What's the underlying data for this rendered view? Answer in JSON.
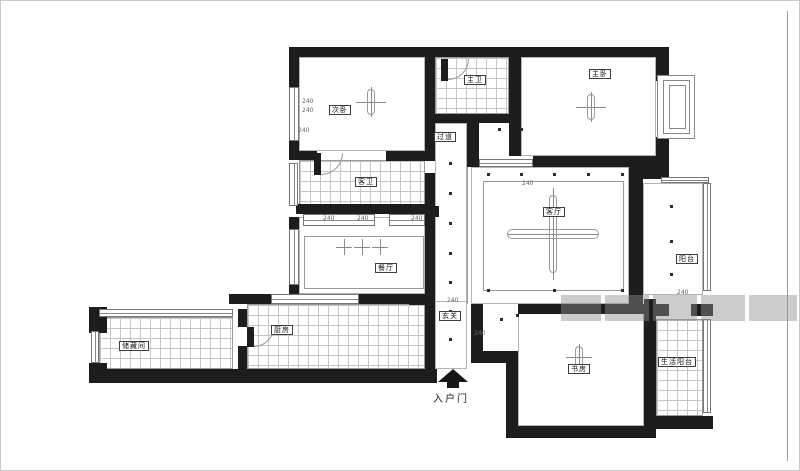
{
  "document": {
    "type": "apartment-floor-plan",
    "background": "#ffffff",
    "wall_color": "#1d1d1d",
    "line_color": "#9a9a9a",
    "watermark_color": "#8f8f8f"
  },
  "plan": {
    "rooms": [
      {
        "id": "ciwo",
        "label": "次卧",
        "x": 298,
        "y": 56,
        "w": 126,
        "h": 94,
        "tiled": false,
        "lx": 328,
        "ly": 104
      },
      {
        "id": "zhuwei",
        "label": "主卫",
        "x": 434,
        "y": 56,
        "w": 74,
        "h": 57,
        "tiled": true,
        "lx": 463,
        "ly": 74
      },
      {
        "id": "zhuwo",
        "label": "主卧",
        "x": 520,
        "y": 56,
        "w": 135,
        "h": 99,
        "tiled": false,
        "lx": 588,
        "ly": 68
      },
      {
        "id": "kewei",
        "label": "客卫",
        "x": 298,
        "y": 159,
        "w": 126,
        "h": 46,
        "tiled": true,
        "lx": 354,
        "ly": 176
      },
      {
        "id": "guodao",
        "label": "过道",
        "x": 434,
        "y": 122,
        "w": 32,
        "h": 246,
        "tiled": false,
        "lx": 433,
        "ly": 131
      },
      {
        "id": "canting",
        "label": "餐厅",
        "x": 298,
        "y": 216,
        "w": 126,
        "h": 77,
        "tiled": false,
        "lx": 374,
        "ly": 262
      },
      {
        "id": "keting",
        "label": "客厅",
        "x": 470,
        "y": 166,
        "w": 158,
        "h": 137,
        "tiled": false,
        "lx": 542,
        "ly": 206
      },
      {
        "id": "yangtai",
        "label": "阳台",
        "x": 642,
        "y": 182,
        "w": 60,
        "h": 112,
        "tiled": false,
        "lx": 675,
        "ly": 253
      },
      {
        "id": "chufang",
        "label": "厨房",
        "x": 246,
        "y": 303,
        "w": 178,
        "h": 65,
        "tiled": true,
        "lx": 270,
        "ly": 324
      },
      {
        "id": "chucangjian",
        "label": "储藏间",
        "x": 98,
        "y": 316,
        "w": 134,
        "h": 52,
        "tiled": true,
        "lx": 118,
        "ly": 340
      },
      {
        "id": "xuanguan",
        "label": "玄关",
        "x": 434,
        "y": 300,
        "w": 32,
        "h": 68,
        "tiled": false,
        "lx": 438,
        "ly": 310
      },
      {
        "id": "shufang",
        "label": "书房",
        "x": 517,
        "y": 305,
        "w": 126,
        "h": 120,
        "tiled": false,
        "lx": 567,
        "ly": 363
      },
      {
        "id": "shenghuoyangtai",
        "label": "生活阳台",
        "x": 655,
        "y": 318,
        "w": 47,
        "h": 97,
        "tiled": true,
        "lx": 657,
        "ly": 356
      }
    ],
    "entry": {
      "label": "入户门",
      "arrow_x": 437,
      "arrow_y": 368,
      "stem_x": 446,
      "stem_y": 381,
      "stem_w": 12,
      "stem_h": 6,
      "label_x": 432,
      "label_y": 389
    },
    "walls": [
      [
        288,
        46,
        380,
        10
      ],
      [
        288,
        56,
        10,
        30
      ],
      [
        288,
        140,
        10,
        18
      ],
      [
        288,
        150,
        28,
        9
      ],
      [
        385,
        150,
        49,
        10
      ],
      [
        424,
        56,
        10,
        96
      ],
      [
        424,
        172,
        10,
        196
      ],
      [
        508,
        56,
        12,
        99
      ],
      [
        432,
        113,
        88,
        9
      ],
      [
        466,
        113,
        12,
        53
      ],
      [
        466,
        155,
        12,
        11
      ],
      [
        532,
        155,
        136,
        11
      ],
      [
        655,
        56,
        13,
        24
      ],
      [
        655,
        136,
        13,
        30
      ],
      [
        628,
        166,
        14,
        137
      ],
      [
        642,
        166,
        26,
        12
      ],
      [
        517,
        303,
        126,
        10
      ],
      [
        643,
        298,
        12,
        130
      ],
      [
        505,
        425,
        150,
        12
      ],
      [
        643,
        415,
        69,
        13
      ],
      [
        470,
        303,
        12,
        55
      ],
      [
        470,
        350,
        47,
        12
      ],
      [
        505,
        360,
        12,
        70
      ],
      [
        88,
        306,
        18,
        26
      ],
      [
        88,
        362,
        18,
        20
      ],
      [
        95,
        368,
        341,
        14
      ],
      [
        228,
        293,
        42,
        10
      ],
      [
        358,
        293,
        66,
        10
      ],
      [
        408,
        293,
        26,
        11
      ],
      [
        237,
        308,
        9,
        18
      ],
      [
        237,
        345,
        9,
        23
      ],
      [
        295,
        203,
        135,
        10
      ],
      [
        424,
        205,
        14,
        11
      ],
      [
        643,
        303,
        25,
        12
      ],
      [
        690,
        303,
        22,
        12
      ],
      [
        288,
        216,
        10,
        12
      ],
      [
        288,
        284,
        10,
        9
      ]
    ],
    "windows": [
      {
        "r": [
          288,
          86,
          10,
          54
        ],
        "o": "v"
      },
      {
        "r": [
          288,
          162,
          9,
          43
        ],
        "o": "v"
      },
      {
        "r": [
          288,
          228,
          10,
          56
        ],
        "o": "v"
      },
      {
        "r": [
          90,
          330,
          8,
          32
        ],
        "o": "v"
      },
      {
        "r": [
          98,
          308,
          134,
          8
        ],
        "o": "h"
      },
      {
        "r": [
          270,
          293,
          88,
          10
        ],
        "o": "h"
      },
      {
        "r": [
          660,
          176,
          48,
          6
        ],
        "o": "h"
      },
      {
        "r": [
          702,
          182,
          8,
          108
        ],
        "o": "v"
      },
      {
        "r": [
          702,
          318,
          8,
          94
        ],
        "o": "v"
      },
      {
        "r": [
          302,
          213,
          72,
          12
        ],
        "o": "h"
      },
      {
        "r": [
          388,
          213,
          36,
          12
        ],
        "o": "h"
      },
      {
        "r": [
          478,
          158,
          54,
          8
        ],
        "o": "h"
      }
    ],
    "bay_window": [
      [
        656,
        74,
        38,
        64
      ],
      [
        662,
        79,
        27,
        54
      ],
      [
        668,
        84,
        17,
        44
      ]
    ],
    "inner_rects": [
      [
        482,
        180,
        141,
        110
      ],
      [
        303,
        235,
        120,
        53
      ]
    ],
    "thin_lines": [
      [
        466,
        166,
        1,
        137
      ],
      [
        786,
        10,
        1,
        450
      ]
    ],
    "door_leaves": [
      [
        440,
        58,
        7,
        22
      ],
      [
        313,
        152,
        7,
        22
      ],
      [
        246,
        326,
        7,
        20
      ]
    ],
    "door_arcs": [
      [
        447,
        58,
        21,
        21
      ],
      [
        320,
        152,
        22,
        22
      ],
      [
        253,
        326,
        20,
        20
      ]
    ],
    "crosses": [
      {
        "x": 552,
        "y": 233,
        "s": 92,
        "kind": "big"
      },
      {
        "x": 370,
        "y": 101,
        "s": 30,
        "kind": "med"
      },
      {
        "x": 590,
        "y": 106,
        "s": 30,
        "kind": "med"
      },
      {
        "x": 578,
        "y": 356,
        "s": 26,
        "kind": "med"
      },
      {
        "x": 343,
        "y": 246,
        "s": 16,
        "kind": "small"
      },
      {
        "x": 361,
        "y": 246,
        "s": 16,
        "kind": "small"
      },
      {
        "x": 379,
        "y": 246,
        "s": 16,
        "kind": "small"
      }
    ],
    "dots": [
      [
        449,
        162
      ],
      [
        449,
        192
      ],
      [
        449,
        222
      ],
      [
        449,
        252
      ],
      [
        449,
        281
      ],
      [
        449,
        310
      ],
      [
        449,
        338
      ],
      [
        487,
        173
      ],
      [
        520,
        173
      ],
      [
        553,
        173
      ],
      [
        587,
        173
      ],
      [
        621,
        173
      ],
      [
        487,
        289
      ],
      [
        553,
        289
      ],
      [
        621,
        289
      ],
      [
        670,
        205
      ],
      [
        670,
        240
      ],
      [
        670,
        273
      ],
      [
        500,
        318
      ],
      [
        516,
        314
      ],
      [
        498,
        128
      ],
      [
        520,
        128
      ]
    ],
    "dimensions": [
      {
        "x": 301,
        "y": 98,
        "t": "240"
      },
      {
        "x": 301,
        "y": 107,
        "t": "240"
      },
      {
        "x": 297,
        "y": 127,
        "t": "240"
      },
      {
        "x": 322,
        "y": 215,
        "t": "240"
      },
      {
        "x": 356,
        "y": 215,
        "t": "240"
      },
      {
        "x": 410,
        "y": 215,
        "t": "240"
      },
      {
        "x": 521,
        "y": 180,
        "t": "240"
      },
      {
        "x": 446,
        "y": 297,
        "t": "240"
      },
      {
        "x": 473,
        "y": 330,
        "t": "240"
      },
      {
        "x": 676,
        "y": 289,
        "t": "240"
      }
    ],
    "watermark_blocks": [
      [
        560,
        294,
        40,
        26
      ],
      [
        604,
        294,
        44,
        26
      ],
      [
        652,
        294,
        44,
        26
      ],
      [
        700,
        294,
        44,
        26
      ],
      [
        748,
        294,
        48,
        26
      ]
    ]
  }
}
